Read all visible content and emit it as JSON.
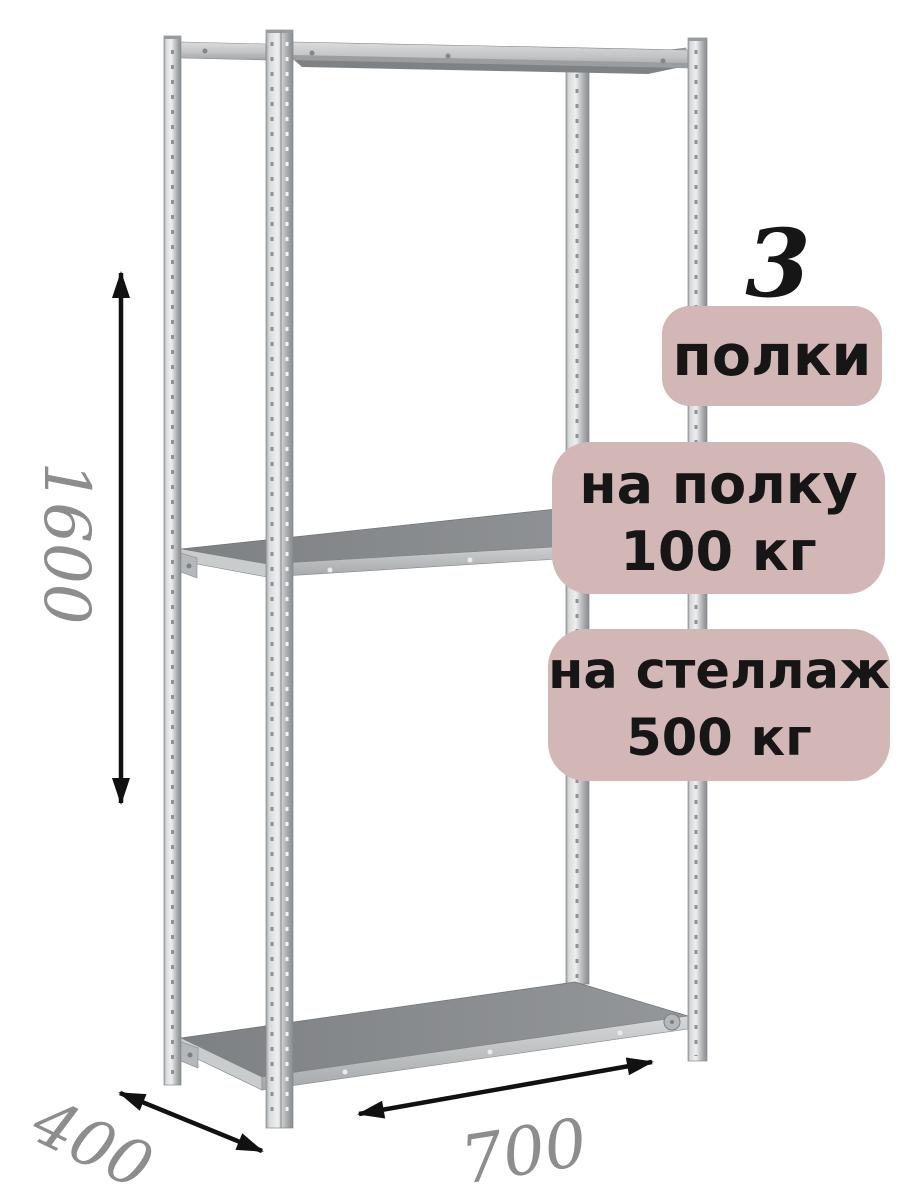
{
  "image": {
    "description": "Isometric product illustration of a grey metal boltless shelving rack with three shelves and dimension arrows"
  },
  "badges": {
    "count_number": "3",
    "count_label": "полки",
    "per_shelf_line1": "на полку",
    "per_shelf_line2": "100 кг",
    "per_rack_line1": "на стеллаж",
    "per_rack_line2": "500 кг"
  },
  "dimensions": {
    "height": "1600",
    "depth": "400",
    "width": "700"
  },
  "colors": {
    "background": "#ffffff",
    "badge_bg": "#d3b7b7",
    "badge_text": "#161616",
    "dim_label": "#8d8d8d",
    "arrow": "#111111",
    "metal_light": "#eef0f0",
    "metal_mid": "#c6c8ca",
    "metal_dark": "#8a8d90"
  }
}
